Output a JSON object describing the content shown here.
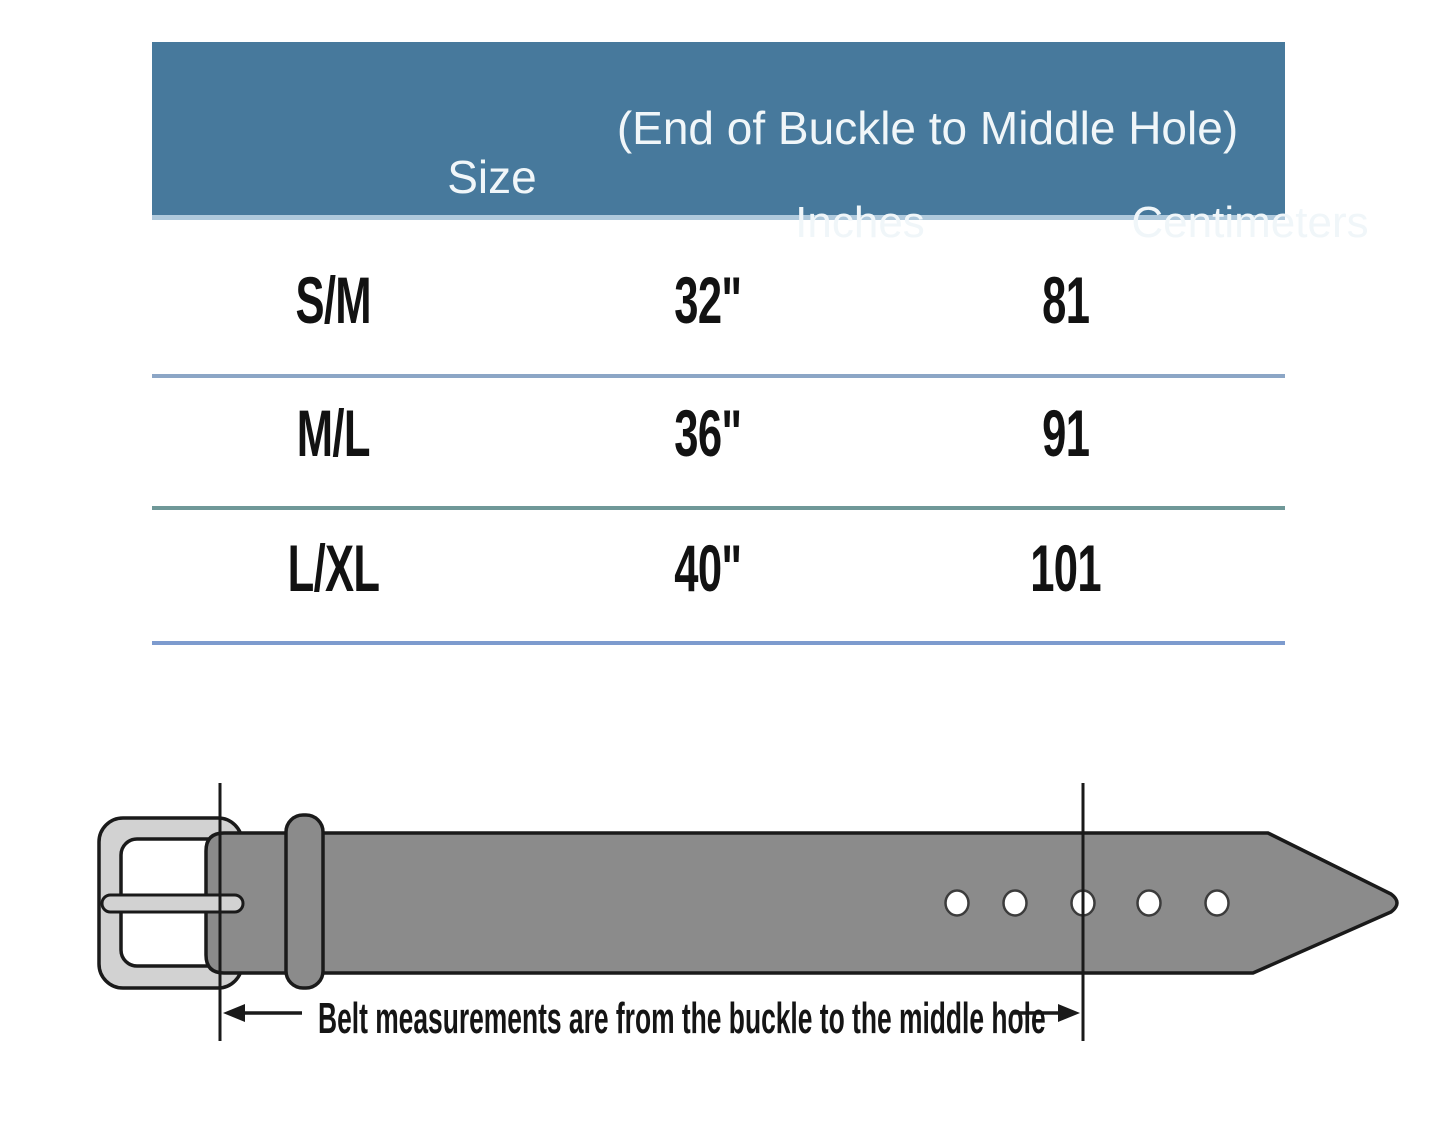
{
  "table": {
    "header": {
      "size_label": "Size",
      "span_label": "(End of Buckle to Middle Hole)",
      "inches_label": "Inches",
      "centimeters_label": "Centimeters",
      "bg_color": "#47799C",
      "text_color": "#F0F6F9"
    },
    "rows": [
      {
        "size": "S/M",
        "inches": "32\"",
        "centimeters": "81"
      },
      {
        "size": "M/L",
        "inches": "36\"",
        "centimeters": "91"
      },
      {
        "size": "L/XL",
        "inches": "40\"",
        "centimeters": "101"
      }
    ],
    "divider_colors": [
      "#8CA6C6",
      "#6F9898",
      "#7D9BCE"
    ]
  },
  "chart_data": {
    "type": "table",
    "title": "(End of Buckle to Middle Hole)",
    "columns": [
      "Size",
      "Inches",
      "Centimeters"
    ],
    "rows": [
      [
        "S/M",
        "32\"",
        81
      ],
      [
        "M/L",
        "36\"",
        91
      ],
      [
        "L/XL",
        "40\"",
        101
      ]
    ]
  },
  "diagram": {
    "annotation": "Belt measurements are from the buckle to the middle hole",
    "hole_count": 5,
    "colors": {
      "belt": "#8B8B8B",
      "buckle": "#D2D2D2",
      "outline": "#1A1A1A",
      "hole_fill": "#FFFFFF"
    }
  }
}
